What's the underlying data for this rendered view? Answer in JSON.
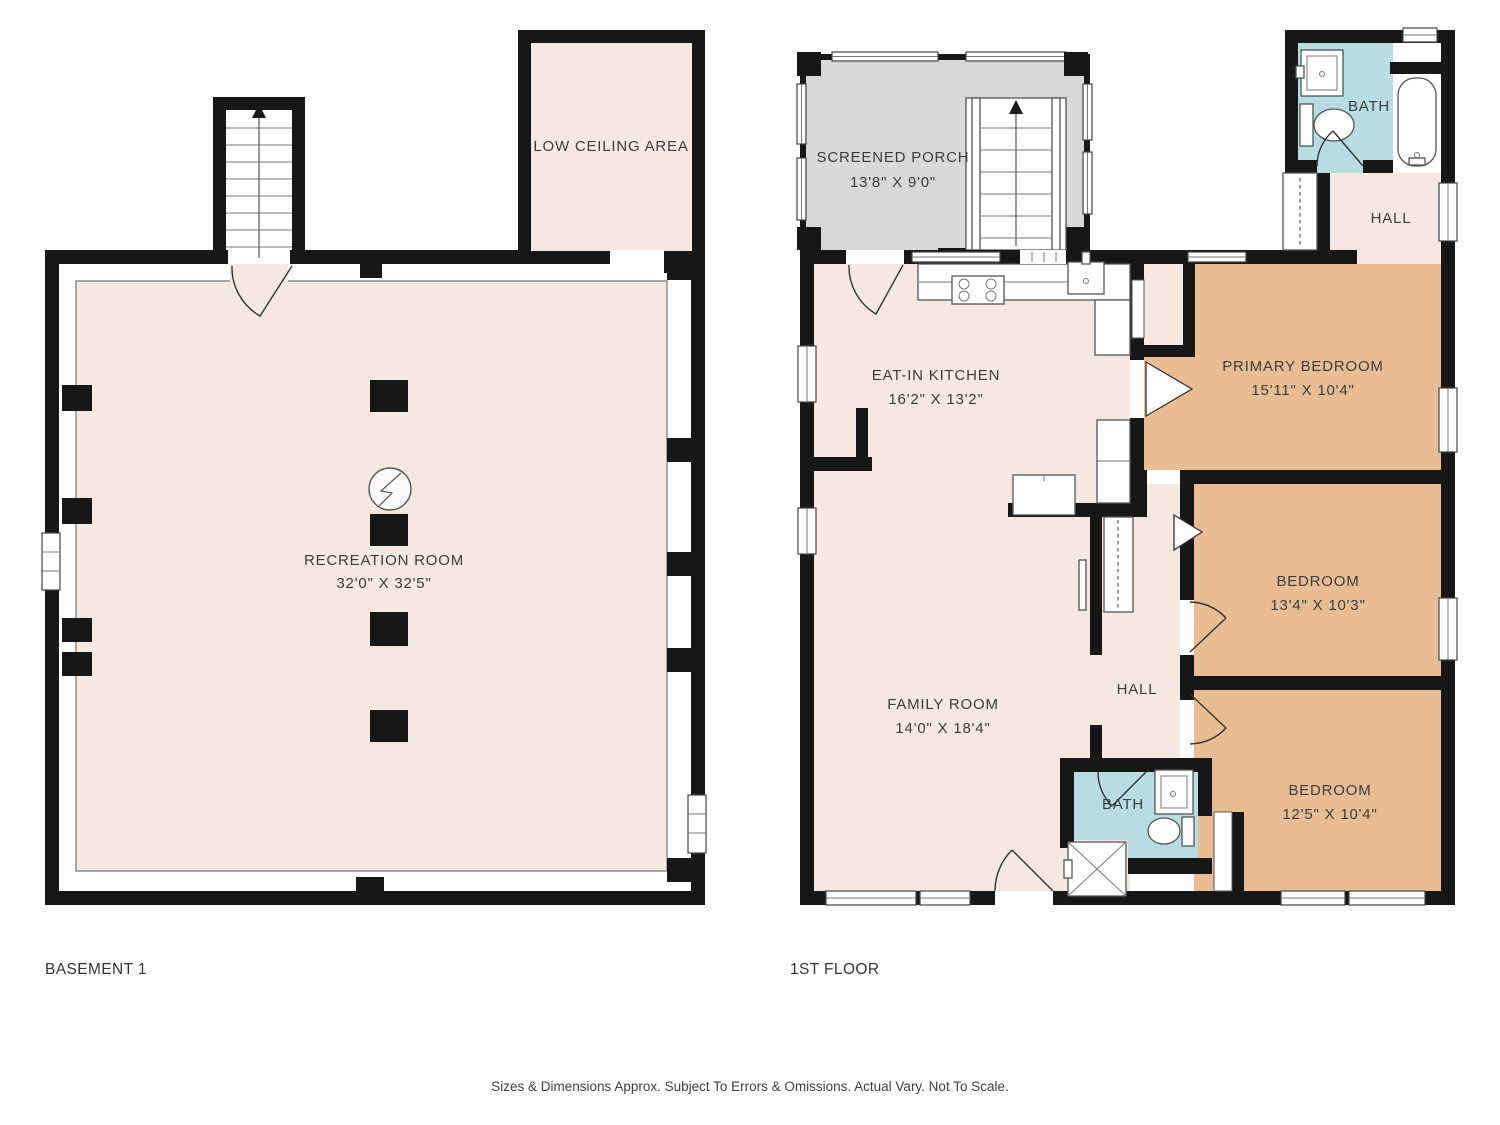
{
  "colors": {
    "wall": "#171717",
    "room_beige": "#f4e8e1",
    "bedroom_tan": "#e9bd93",
    "bath_blue": "#b7dce2",
    "porch_gray": "#d8d8d8",
    "label_text": "#3c3c3c"
  },
  "basement": {
    "title": "BASEMENT 1",
    "rooms": {
      "low_ceiling": {
        "name": "LOW CEILING AREA"
      },
      "recreation": {
        "name": "RECREATION ROOM",
        "dims": "32'0\" X 32'5\""
      }
    }
  },
  "first_floor": {
    "title": "1ST FLOOR",
    "rooms": {
      "screened_porch": {
        "name": "SCREENED PORCH",
        "dims": "13'8\" X 9'0\""
      },
      "bath_top": {
        "name": "BATH"
      },
      "hall_top": {
        "name": "HALL"
      },
      "eat_in_kitchen": {
        "name": "EAT-IN KITCHEN",
        "dims": "16'2\" X 13'2\""
      },
      "primary_bedroom": {
        "name": "PRIMARY BEDROOM",
        "dims": "15'11\" X 10'4\""
      },
      "bedroom_middle": {
        "name": "BEDROOM",
        "dims": "13'4\" X 10'3\""
      },
      "family_room": {
        "name": "FAMILY ROOM",
        "dims": "14'0\" X 18'4\""
      },
      "hall_middle": {
        "name": "HALL"
      },
      "bath_bottom": {
        "name": "BATH"
      },
      "bedroom_bottom": {
        "name": "BEDROOM",
        "dims": "12'5\" X 10'4\""
      }
    }
  },
  "footer": {
    "disclaimer": "Sizes & Dimensions Approx. Subject To Errors & Omissions. Actual Vary. Not To Scale."
  }
}
